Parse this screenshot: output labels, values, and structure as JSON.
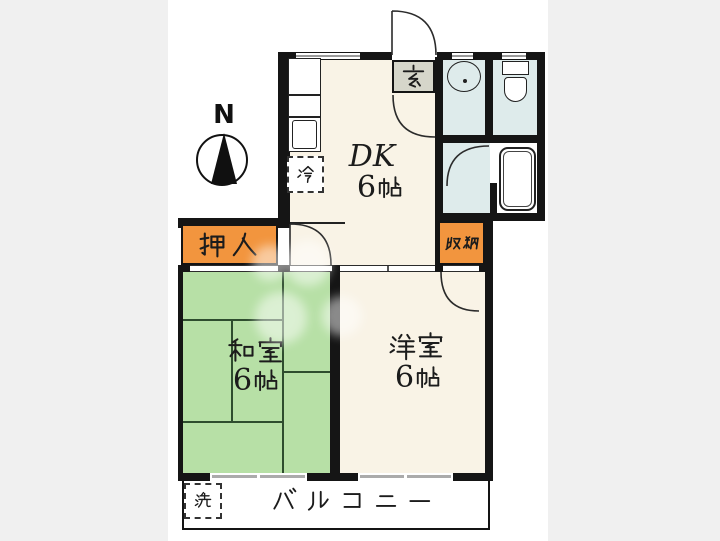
{
  "plan": {
    "compass_label": "N",
    "rooms": {
      "dk": {
        "name": "DK",
        "size": "6帖"
      },
      "washitsu": {
        "name": "和室",
        "size": "6帖"
      },
      "youshitsu": {
        "name": "洋室",
        "size": "6帖"
      },
      "genkan": {
        "name": "玄"
      },
      "oshiire": {
        "name": "押入"
      },
      "shuunou": {
        "name": "収納"
      },
      "balcony": {
        "name": "バルコニー"
      }
    },
    "appliances": {
      "refrigerator": {
        "name": "冷"
      },
      "washer": {
        "name": "洗"
      }
    },
    "colors": {
      "background": "#f0f0f0",
      "paper": "#ffffff",
      "wall": "#151515",
      "tatami_green": "#B7E0A6",
      "tatami_line": "#2e4d2e",
      "room_cream": "#F9F3E6",
      "wet_area_blue": "#DEEBEB",
      "closet_orange": "#F2953E",
      "genkan_gray": "#D6D6CA"
    }
  }
}
